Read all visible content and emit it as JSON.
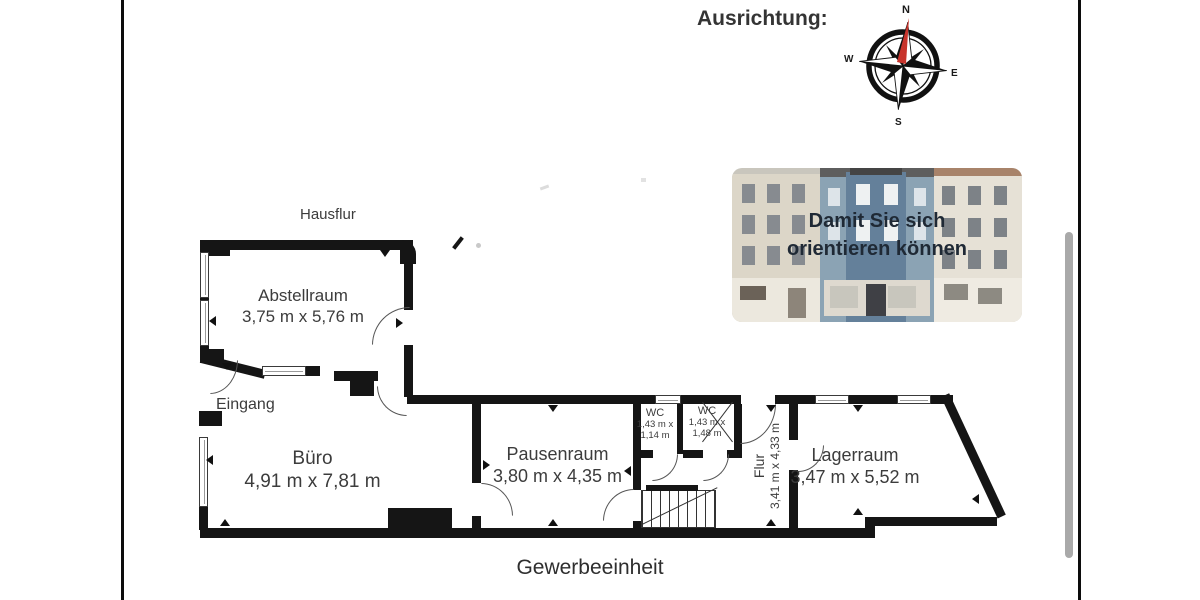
{
  "header": {
    "orientation_label": "Ausrichtung:"
  },
  "compass": {
    "north": "N",
    "east": "E",
    "south": "S",
    "west": "W",
    "needle_color": "#c8342c"
  },
  "photo": {
    "caption_line1": "Damit Sie sich",
    "caption_line2": "orientieren können"
  },
  "floorplan": {
    "outside_label": "Hausflur",
    "entrance_label": "Eingang",
    "unit_label": "Gewerbeeinheit",
    "wall_color": "#151515",
    "rooms": [
      {
        "name": "Abstellraum",
        "dims": "3,75 m x 5,76 m"
      },
      {
        "name": "Büro",
        "dims": "4,91 m x 7,81 m"
      },
      {
        "name": "Pausenraum",
        "dims": "3,80 m x 4,35 m"
      },
      {
        "name": "WC",
        "dims_line1": "1,43 m x",
        "dims_line2": "1,14 m"
      },
      {
        "name": "WC",
        "dims_line1": "1,43 m x",
        "dims_line2": "1,48 m"
      },
      {
        "name": "Flur",
        "dims": "3,41 m x 4,33 m"
      },
      {
        "name": "Lagerraum",
        "dims": "3,47 m x 5,52 m"
      }
    ]
  }
}
